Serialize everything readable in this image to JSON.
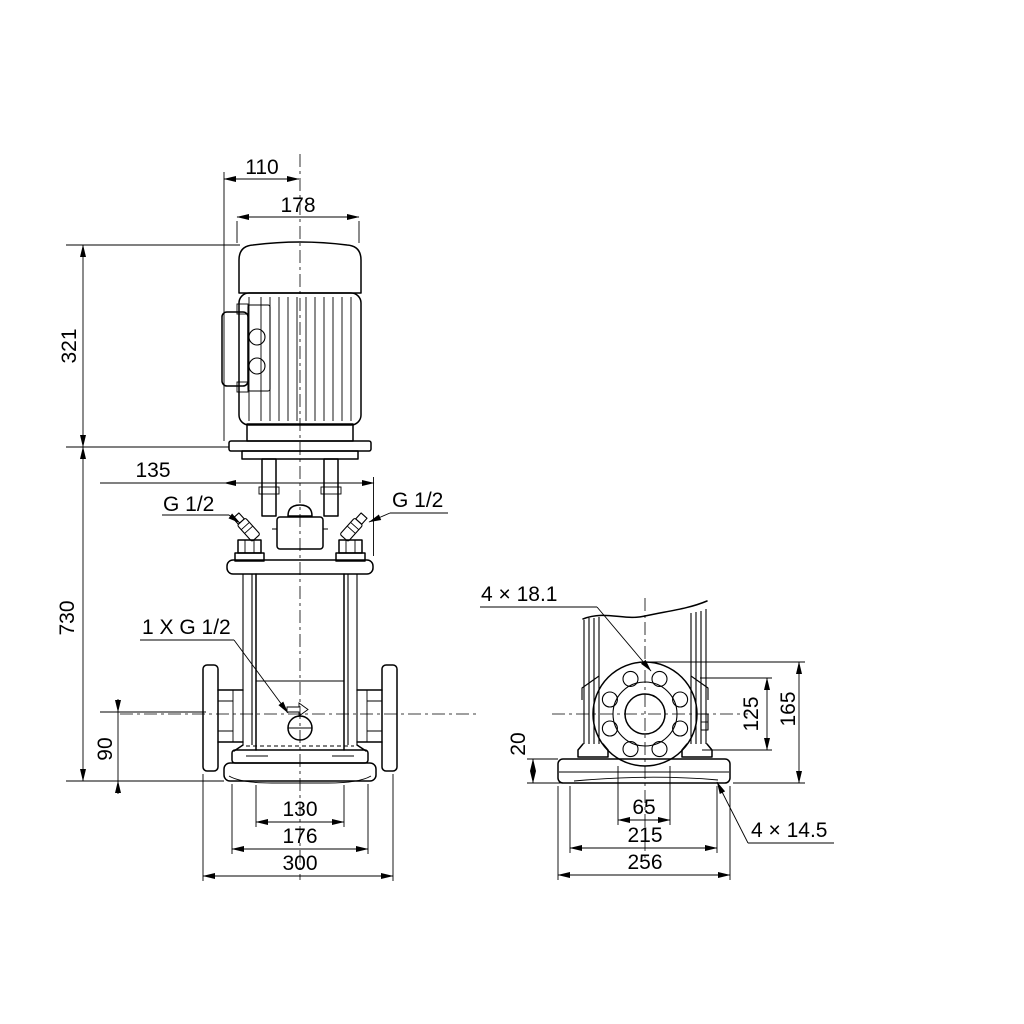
{
  "front_view": {
    "dim_110": "110",
    "dim_178": "178",
    "dim_321": "321",
    "dim_135": "135",
    "dim_730": "730",
    "dim_90": "90",
    "dim_130": "130",
    "dim_176": "176",
    "dim_300": "300",
    "label_vent_left": "G 1/2",
    "label_vent_right": "G 1/2",
    "label_drain": "1 X G 1/2"
  },
  "side_view": {
    "label_flange_holes": "4 × 18.1",
    "dim_20": "20",
    "dim_125": "125",
    "dim_165": "165",
    "dim_65": "65",
    "dim_215": "215",
    "dim_256": "256",
    "label_base_holes": "4 × 14.5"
  }
}
